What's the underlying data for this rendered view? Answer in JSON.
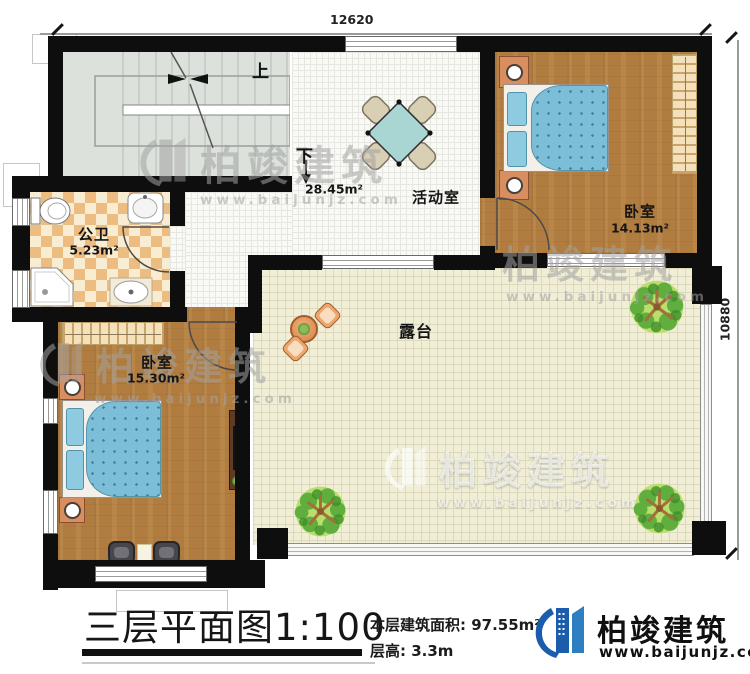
{
  "dimensions": {
    "top": "12620",
    "right": "10880"
  },
  "stairs": {
    "up": "上",
    "down": "下"
  },
  "rooms": {
    "activity": {
      "name": "活动室",
      "area": "28.45m²"
    },
    "bedroom_top": {
      "name": "卧室",
      "area": "14.13m²"
    },
    "bathroom": {
      "name": "公卫",
      "area": "5.23m²"
    },
    "bedroom_bottom": {
      "name": "卧室",
      "area": "15.30m²"
    },
    "terrace": {
      "name": "露台"
    }
  },
  "footer": {
    "title": "三层平面图1:100",
    "area_line": "本层建筑面积: 97.55m²",
    "height_line": "层高: 3.3m"
  },
  "branding": {
    "company": "柏竣建筑",
    "website": "www.baijunjz.com"
  },
  "watermark": {
    "company": "柏竣建筑",
    "website": "www.baijunjz.com"
  },
  "colors": {
    "wall": "#0e0e0e",
    "wood": "#b17c3f",
    "terrace_tile": "#f0eed7",
    "bath_tile": "#ecbc80",
    "bed_blue": "#7cbdd7",
    "logo_blue": "#1b5dab"
  }
}
